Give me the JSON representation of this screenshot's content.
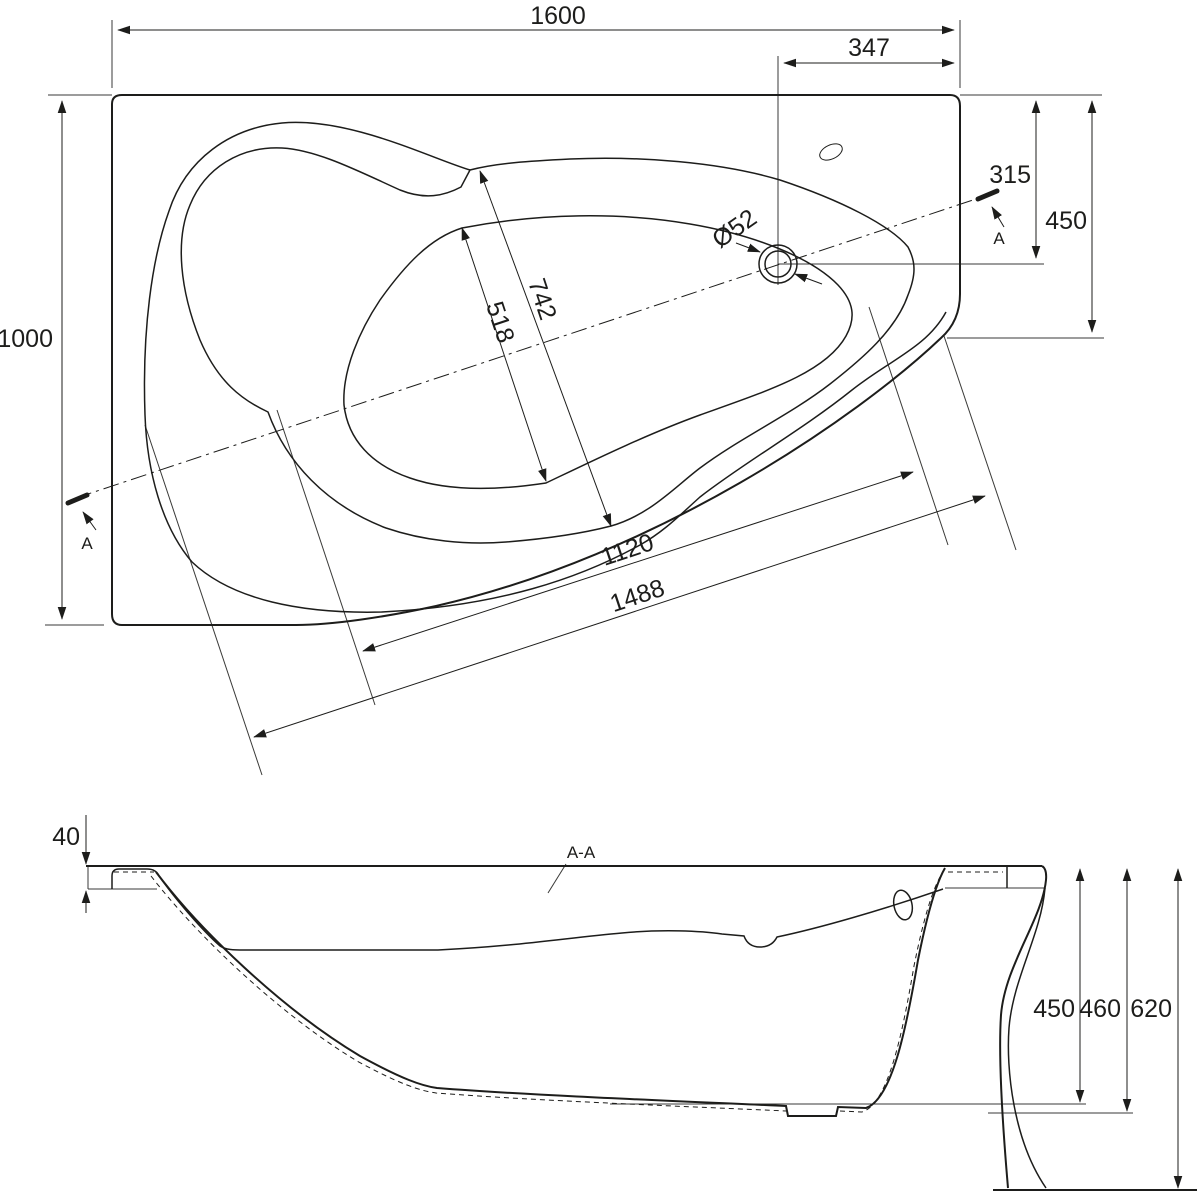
{
  "drawing": {
    "type": "bathtub technical drawing",
    "background_color": "#ffffff",
    "line_color": "#1d1d1b",
    "plan_view": {
      "dimensions": {
        "overall_length": "1600",
        "drain_offset_from_right": "347",
        "overall_width": "1000",
        "drain_offset_from_top": "315",
        "right_side_depth": "450",
        "well_top_width": "742",
        "well_floor_width": "518",
        "inner_length": "1120",
        "outer_rim_length": "1488",
        "drain_diameter": "Ø52"
      },
      "section_cut_marker": "A"
    },
    "section_view": {
      "label": "A-A",
      "dimensions": {
        "rim_edge_height": "40",
        "inner_depth": "450",
        "shell_height": "460",
        "overall_height": "620"
      }
    }
  }
}
